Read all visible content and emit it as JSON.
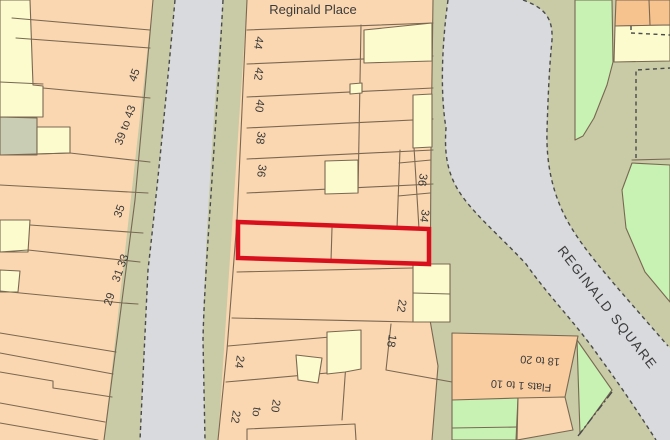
{
  "labels": {
    "place": "Reginald Place",
    "square": "REGINALD SQUARE",
    "flats": "Flats 1 to 10",
    "flats_range": "18 to 20",
    "n45": "45",
    "n39_43": "39 to 43",
    "n35": "35",
    "n31_33": "31 33",
    "n29": "29",
    "n44": "44",
    "n42": "42",
    "n40": "40",
    "n38": "38",
    "n36": "36",
    "n36b": "36",
    "n34": "34",
    "n24": "24",
    "n22": "22",
    "n18": "18",
    "p20": "20",
    "pto": "to",
    "p22": "22"
  },
  "colors": {
    "peach": "#fad7b0",
    "yellow": "#fbfbce",
    "green": "#c7f2b4",
    "olive": "#c8cba6",
    "sage": "#c9cdb4",
    "grey": "#d9dade",
    "orange": "#f6c28e",
    "flats_orange": "#f9cda0",
    "red": "#d8101e"
  }
}
